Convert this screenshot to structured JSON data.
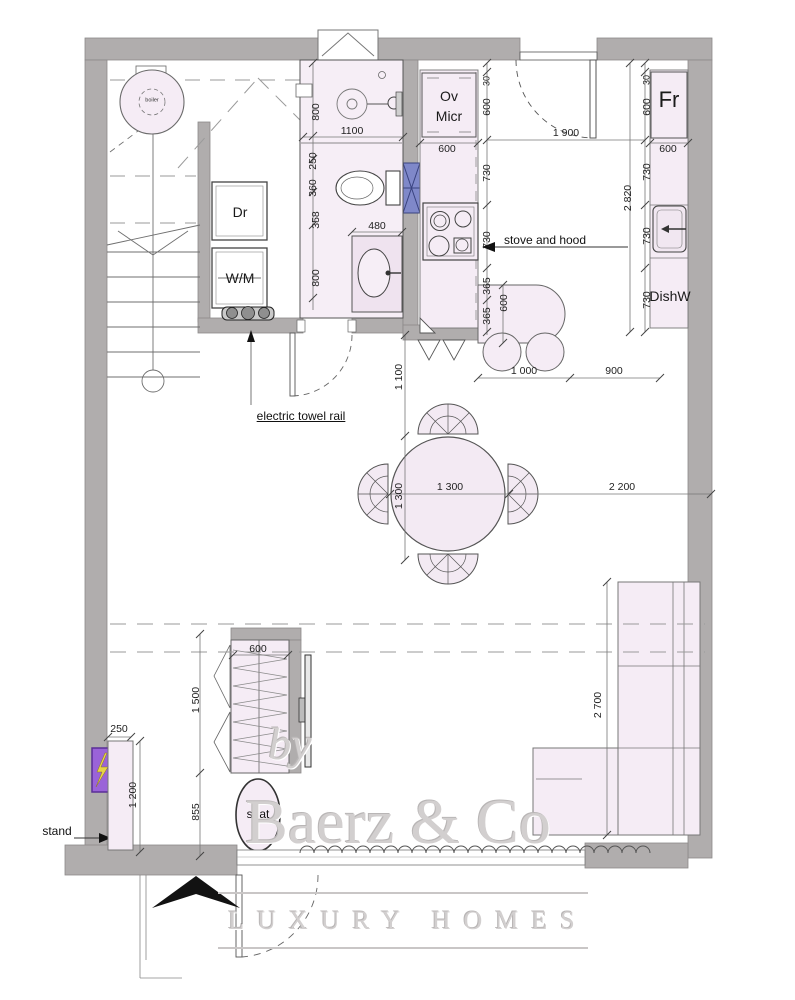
{
  "title": "apartment floor plan",
  "colors": {
    "wall": "#b0adad",
    "furniture_fill": "#f5ecf5",
    "bath_fill": "#f6eef6",
    "duct_blue": "#7f88c9",
    "panel_purple": "#9a63d8",
    "bolt_yellow": "#e7d348",
    "line": "#555555",
    "dash": "#999999",
    "watermark": "#d2cfcf"
  },
  "watermark": {
    "by": "by",
    "brand": "Baerz & Co",
    "tagline": "LUXURY HOMES"
  },
  "labels": [
    {
      "name": "label-boiler",
      "text": "boiler",
      "x": 152,
      "y": 101,
      "cls": "app-tiny"
    },
    {
      "name": "label-dryer",
      "text": "Dr",
      "x": 240,
      "y": 212,
      "cls": "app"
    },
    {
      "name": "label-washing-machine",
      "text": "W/M",
      "x": 240,
      "y": 278,
      "cls": "app"
    },
    {
      "name": "label-oven",
      "text": "Ov",
      "x": 449,
      "y": 96,
      "cls": "app"
    },
    {
      "name": "label-microwave",
      "text": "Micr",
      "x": 449,
      "y": 116,
      "cls": "app"
    },
    {
      "name": "label-fridge",
      "text": "Fr",
      "x": 669,
      "y": 100,
      "cls": "app-big"
    },
    {
      "name": "label-dishwasher",
      "text": "DishW",
      "x": 670,
      "y": 296,
      "cls": "app"
    },
    {
      "name": "label-stove-and-hood",
      "text": "stove and hood",
      "x": 545,
      "y": 240,
      "cls": "note"
    },
    {
      "name": "label-electric-towel-rail",
      "text": "electric towel rail",
      "x": 301,
      "y": 416,
      "cls": "note underline"
    },
    {
      "name": "label-stand",
      "text": "stand",
      "x": 57,
      "y": 831,
      "cls": "note"
    },
    {
      "name": "label-seat",
      "text": "seat",
      "x": 258,
      "y": 814,
      "cls": "note"
    },
    {
      "name": "dim-shower-800",
      "text": "800",
      "x": 316,
      "y": 112,
      "rot": true
    },
    {
      "name": "dim-bath-1100",
      "text": "1100",
      "x": 352,
      "y": 131
    },
    {
      "name": "dim-bath-250",
      "text": "250",
      "x": 313,
      "y": 161,
      "rot": true
    },
    {
      "name": "dim-bath-360",
      "text": "360",
      "x": 313,
      "y": 188,
      "rot": true
    },
    {
      "name": "dim-bath-358",
      "text": "358",
      "x": 316,
      "y": 220,
      "rot": true
    },
    {
      "name": "dim-bath-800",
      "text": "800",
      "x": 316,
      "y": 278,
      "rot": true
    },
    {
      "name": "dim-sink-480",
      "text": "480",
      "x": 377,
      "y": 226
    },
    {
      "name": "dim-ovmicr-600",
      "text": "600",
      "x": 447,
      "y": 149
    },
    {
      "name": "dim-kl-30",
      "text": "30",
      "x": 487,
      "y": 81,
      "rot": true,
      "cls": "small"
    },
    {
      "name": "dim-kl-600",
      "text": "600",
      "x": 487,
      "y": 107,
      "rot": true
    },
    {
      "name": "dim-kl-730a",
      "text": "730",
      "x": 487,
      "y": 173,
      "rot": true
    },
    {
      "name": "dim-kl-730b",
      "text": "730",
      "x": 487,
      "y": 240,
      "rot": true
    },
    {
      "name": "dim-kl-365a",
      "text": "365",
      "x": 487,
      "y": 286,
      "rot": true
    },
    {
      "name": "dim-kl-365b",
      "text": "365",
      "x": 487,
      "y": 316,
      "rot": true
    },
    {
      "name": "dim-peninsula-600",
      "text": "600",
      "x": 504,
      "y": 303,
      "rot": true
    },
    {
      "name": "dim-entry-1900",
      "text": "1 900",
      "x": 566,
      "y": 133
    },
    {
      "name": "dim-fridge-600",
      "text": "600",
      "x": 668,
      "y": 149
    },
    {
      "name": "dim-kr-30",
      "text": "30",
      "x": 647,
      "y": 80,
      "rot": true,
      "cls": "small"
    },
    {
      "name": "dim-kr-600",
      "text": "600",
      "x": 647,
      "y": 107,
      "rot": true
    },
    {
      "name": "dim-kr-730a",
      "text": "730",
      "x": 647,
      "y": 172,
      "rot": true
    },
    {
      "name": "dim-kr-730b",
      "text": "730",
      "x": 647,
      "y": 236,
      "rot": true
    },
    {
      "name": "dim-kr-730c",
      "text": "730",
      "x": 647,
      "y": 300,
      "rot": true
    },
    {
      "name": "dim-kitchen-2820",
      "text": "2 820",
      "x": 628,
      "y": 198,
      "rot": true
    },
    {
      "name": "dim-bar-1000",
      "text": "1 000",
      "x": 524,
      "y": 371
    },
    {
      "name": "dim-bar-900",
      "text": "900",
      "x": 614,
      "y": 371
    },
    {
      "name": "dim-hall-1100",
      "text": "1 100",
      "x": 399,
      "y": 377,
      "rot": true
    },
    {
      "name": "dim-table-1300-h",
      "text": "1 300",
      "x": 450,
      "y": 487
    },
    {
      "name": "dim-table-1300-v",
      "text": "1 300",
      "x": 399,
      "y": 496,
      "rot": true
    },
    {
      "name": "dim-living-2200",
      "text": "2 200",
      "x": 622,
      "y": 487
    },
    {
      "name": "dim-wardrobe-600",
      "text": "600",
      "x": 258,
      "y": 649
    },
    {
      "name": "dim-wardrobe-1500",
      "text": "1 500",
      "x": 196,
      "y": 700,
      "rot": true
    },
    {
      "name": "dim-wardrobe-855",
      "text": "855",
      "x": 196,
      "y": 812,
      "rot": true
    },
    {
      "name": "dim-stand-250",
      "text": "250",
      "x": 119,
      "y": 729
    },
    {
      "name": "dim-stand-1200",
      "text": "1 200",
      "x": 133,
      "y": 795,
      "rot": true
    },
    {
      "name": "dim-sofa-2700",
      "text": "2 700",
      "x": 598,
      "y": 705,
      "rot": true
    },
    {
      "name": "wm-by",
      "text": "by",
      "x": 290,
      "y": 744,
      "cls": "wm wm-by"
    },
    {
      "name": "wm-brand",
      "text": "Baerz & Co",
      "x": 398,
      "y": 822,
      "cls": "wm wm-brand"
    },
    {
      "name": "wm-tagline",
      "text": "LUXURY HOMES",
      "x": 408,
      "y": 921,
      "cls": "wm wm-tag"
    }
  ]
}
